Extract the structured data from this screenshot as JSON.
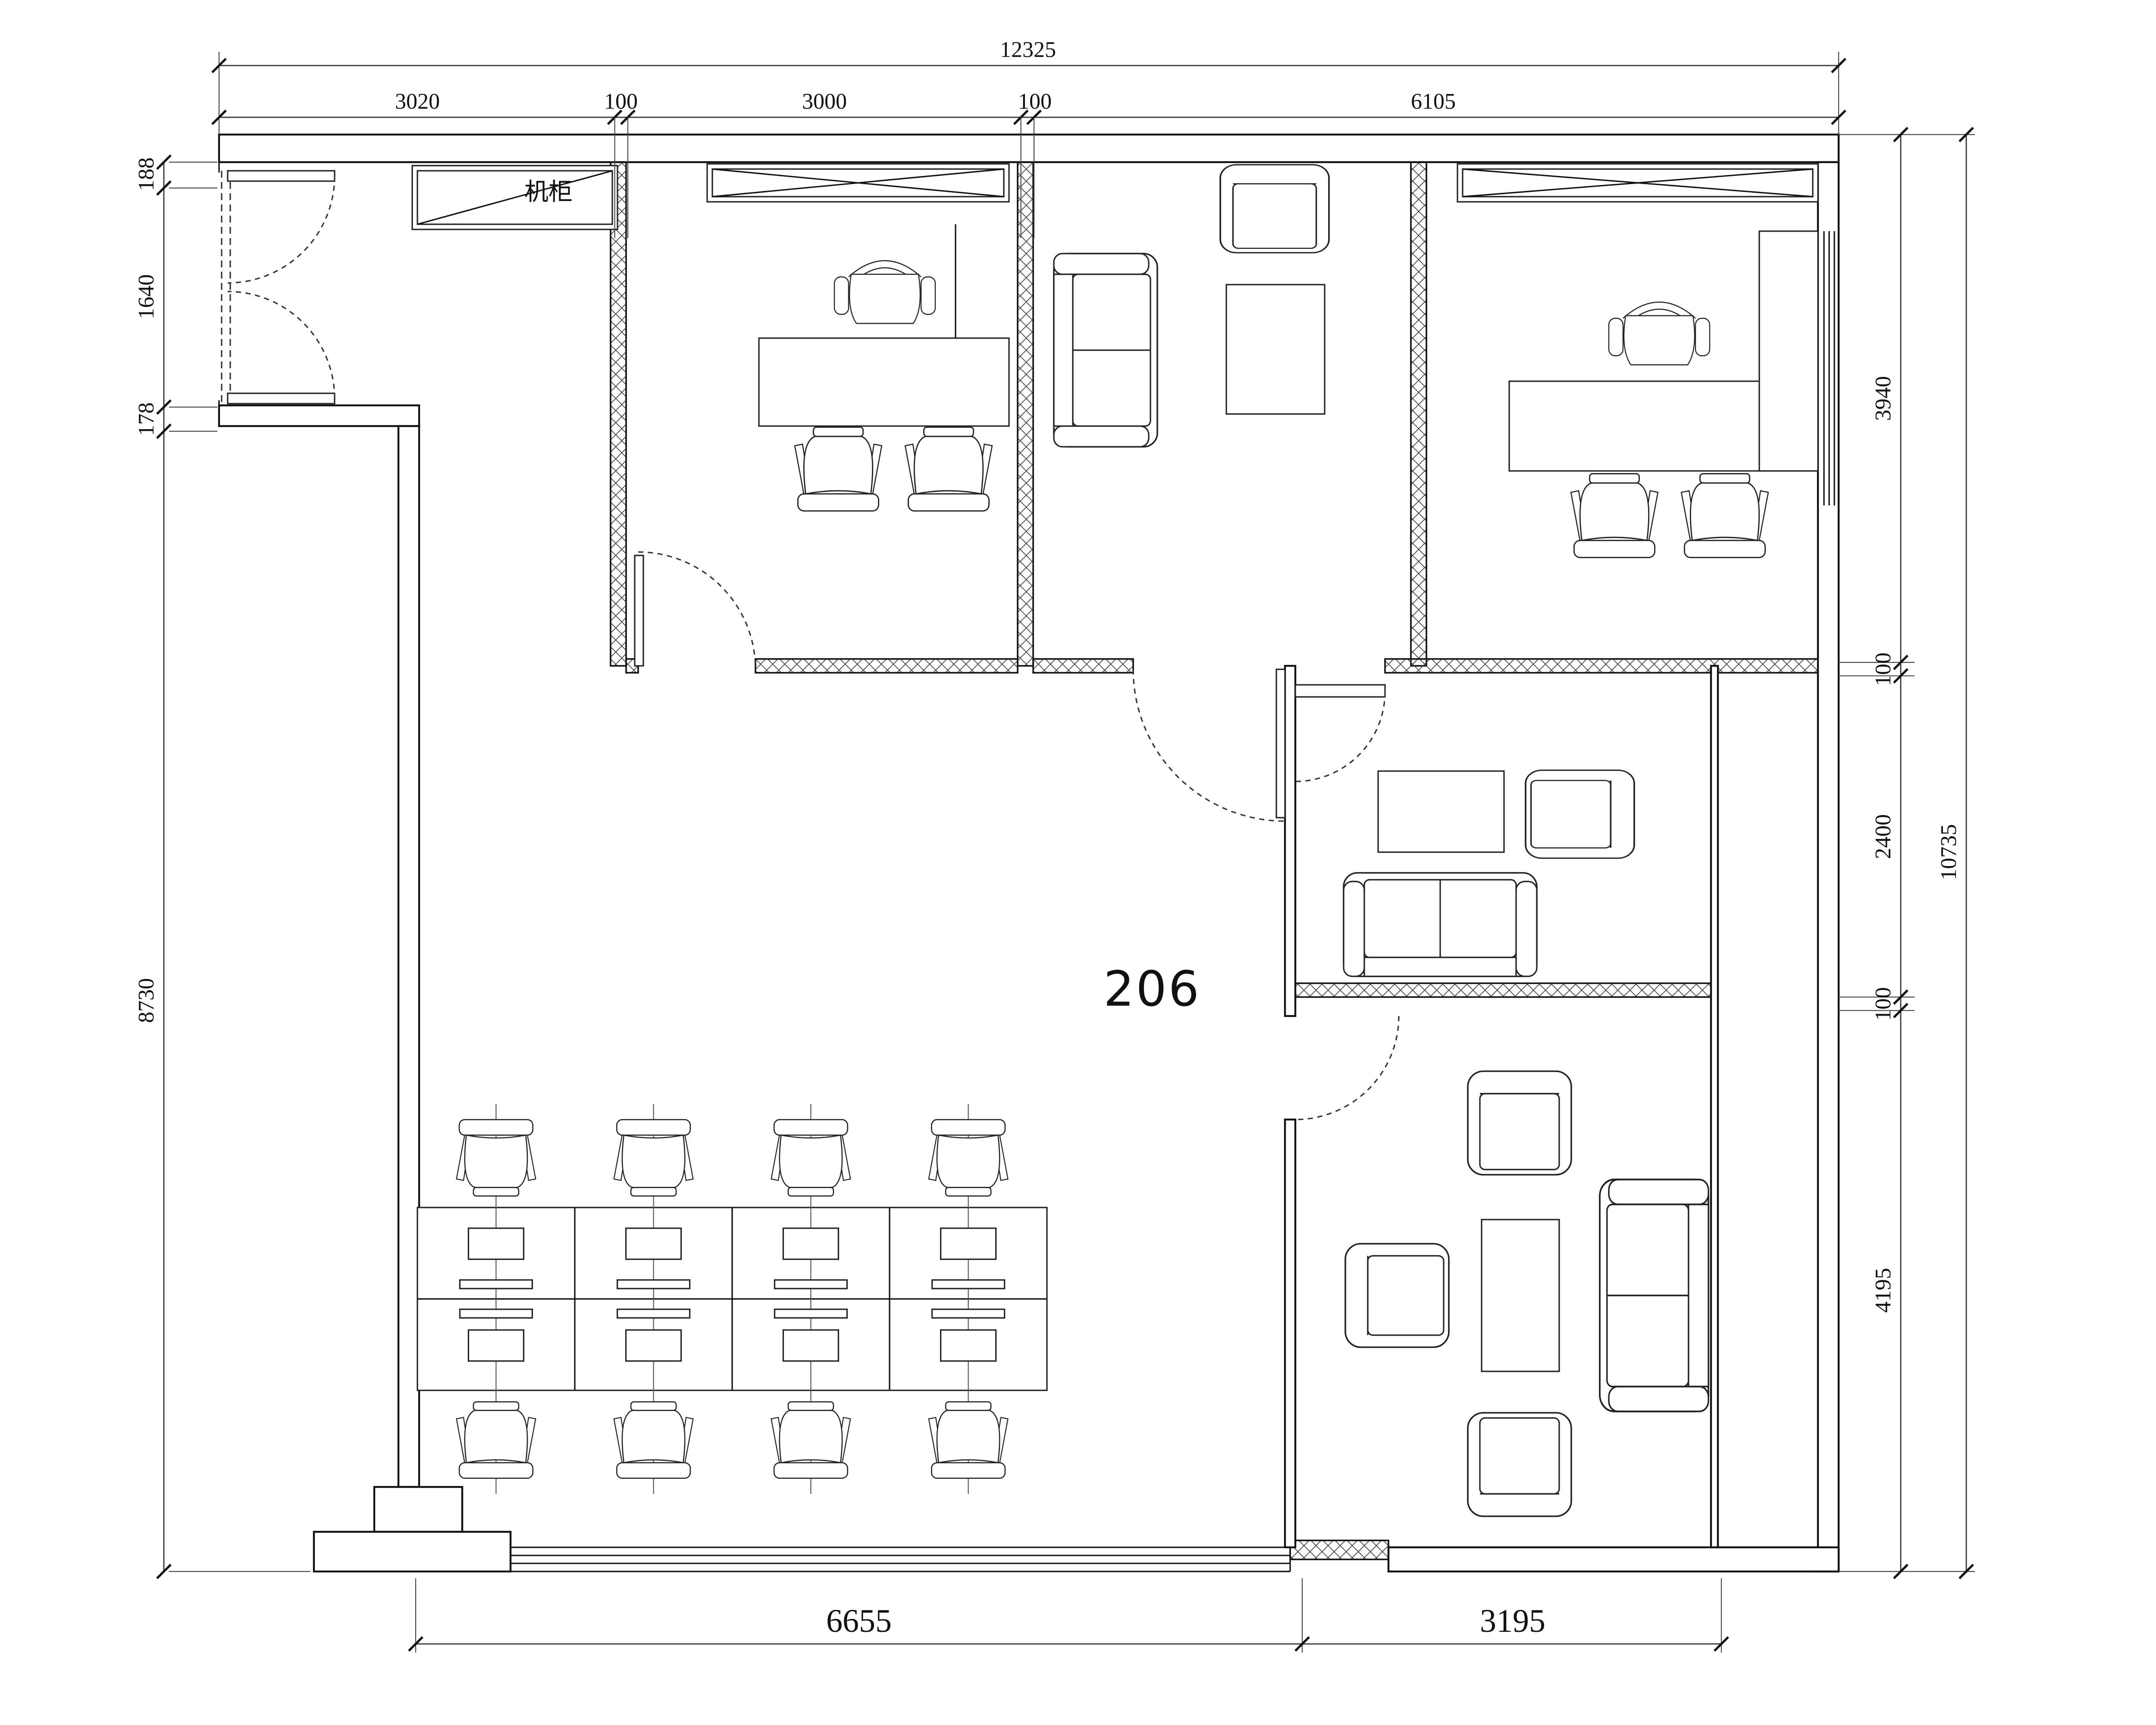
{
  "labels": {
    "room_number": "206",
    "cabinet": "机柜"
  },
  "dimensions": {
    "top_total": "12325",
    "top_segments": [
      "3020",
      "100",
      "3000",
      "100",
      "6105"
    ],
    "left_segments": [
      "188",
      "1640",
      "178",
      "8730"
    ],
    "right_segments": [
      "3940",
      "100",
      "2400",
      "100",
      "4195"
    ],
    "right_total": "10735",
    "bottom_segments": [
      "6655",
      "3195"
    ]
  }
}
